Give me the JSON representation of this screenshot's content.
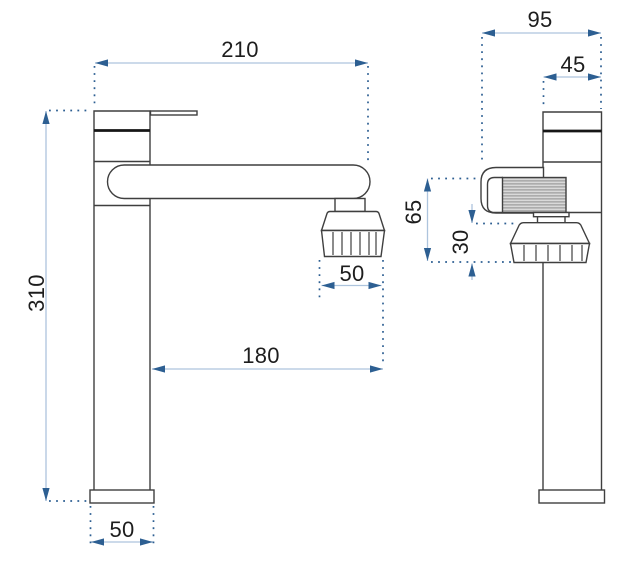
{
  "drawing": {
    "kind": "faucet-two-view-dimension-drawing"
  },
  "dimensions": {
    "front": {
      "spout_reach": "210",
      "total_height": "310",
      "aerator_width": "50",
      "reach_to_aerator": "180",
      "base_width": "50"
    },
    "side": {
      "total_depth": "95",
      "body_depth": "45",
      "spout_section_height": "65",
      "aerator_section_height": "30"
    }
  },
  "colors": {
    "background": "#ffffff",
    "outline": "#3f3f3f",
    "dimension_line": "#adc4dd",
    "dimension_marks": "#2d5f92",
    "label_text": "#1d1d1d",
    "knurl_fill": "#d9d9d9"
  }
}
